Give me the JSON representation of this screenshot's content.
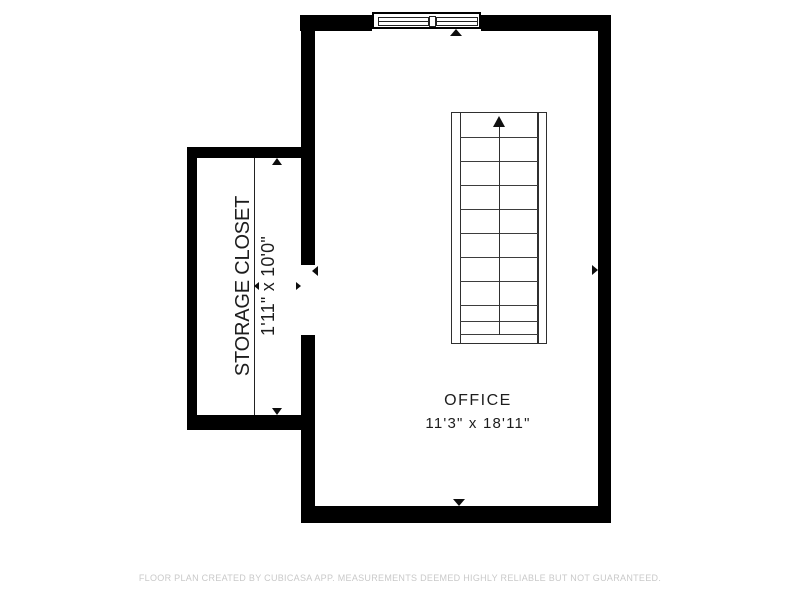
{
  "rooms": [
    {
      "name": "OFFICE",
      "dimensions": "11'3\" x 18'11\""
    },
    {
      "name": "STORAGE CLOSET",
      "dimensions": "1'11\" x 10'0\""
    }
  ],
  "footer": {
    "text": "FLOOR PLAN CREATED BY CUBICASA APP. MEASUREMENTS DEEMED HIGHLY RELIABLE BUT NOT GUARANTEED."
  },
  "features": {
    "stairs_direction": "up",
    "window_panes": 2,
    "door_openings": 1
  },
  "colors": {
    "wall": "#000000",
    "background": "#ffffff",
    "room_text": "#1d1d1d",
    "stair_lines": "#2f2f2f",
    "footer_text": "#c9c9c9",
    "arrow": "#0d0d0d"
  }
}
